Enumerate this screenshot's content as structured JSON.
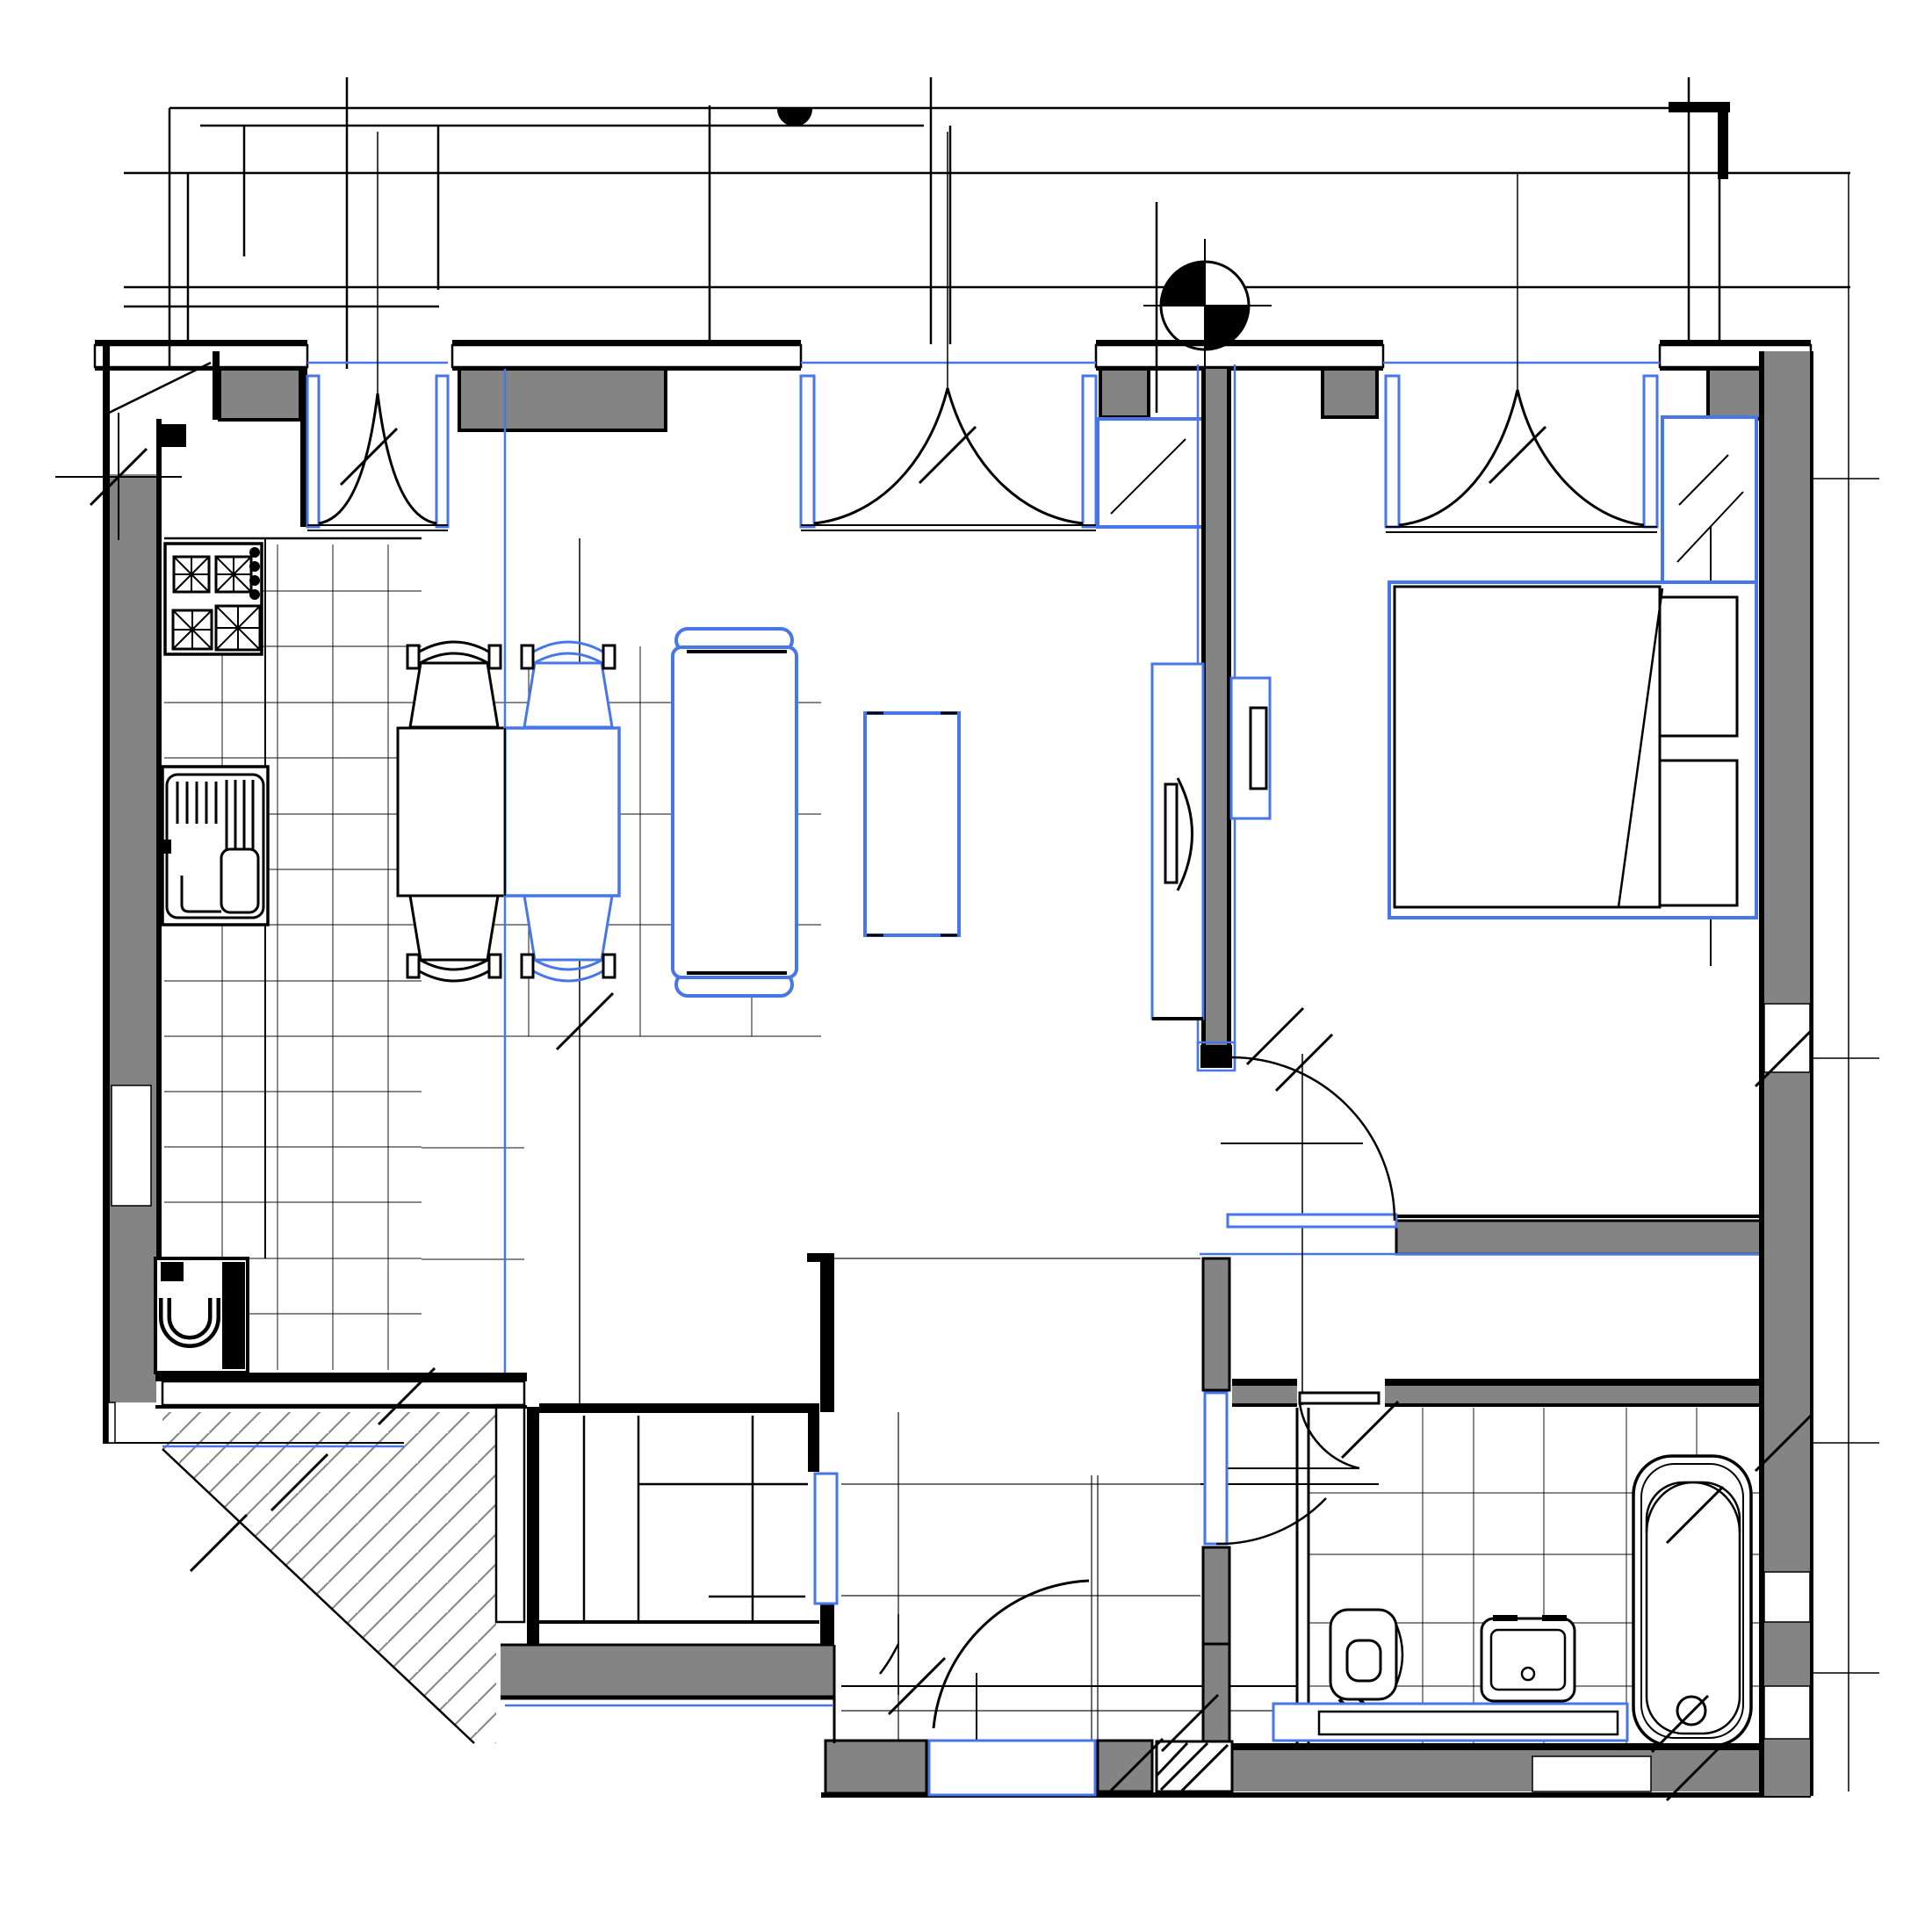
{
  "meta": {
    "document_kind": "architectural-floor-plan",
    "description": "One-bedroom apartment CAD floor plan with existing (black) and proposed (blue) layout layers",
    "visible_text": []
  },
  "colors": {
    "line": "#000000",
    "wall": "#848484",
    "blue": "#4676e8",
    "hatch": "#8a8a8a",
    "bg": "#ffffff"
  },
  "layers": [
    {
      "id": "existing",
      "label": "existing construction (black)"
    },
    {
      "id": "proposed",
      "label": "proposed / furniture layer (blue)"
    }
  ],
  "rooms": [
    {
      "id": "kitchen-living",
      "label": "Kitchen / living room"
    },
    {
      "id": "bedroom",
      "label": "Bedroom"
    },
    {
      "id": "bathroom",
      "label": "Bathroom"
    },
    {
      "id": "hallway",
      "label": "Entry hallway"
    },
    {
      "id": "wardrobe",
      "label": "Wardrobe room"
    },
    {
      "id": "facade",
      "label": "Facade / balcony zone above plan"
    }
  ],
  "fixtures": [
    {
      "id": "stove",
      "label": "4-burner cooktop with control knobs"
    },
    {
      "id": "kitchen-sink",
      "label": "Kitchen sink with drainer"
    },
    {
      "id": "water-heater",
      "label": "Water heater / washing unit"
    },
    {
      "id": "dining-table",
      "label": "Dining table (black + blue halves)"
    },
    {
      "id": "chairs",
      "label": "Four dining chairs (2 black, 2 blue)"
    },
    {
      "id": "sofa",
      "label": "Sofa (blue layer)"
    },
    {
      "id": "coffee-table",
      "label": "Coffee table (blue layer)"
    },
    {
      "id": "tv-unit",
      "label": "TV wall unit on partition"
    },
    {
      "id": "bed",
      "label": "Double bed with pillows"
    },
    {
      "id": "bedroom-shelf",
      "label": "Bedroom-side shelf on partition"
    },
    {
      "id": "wardrobe-unit",
      "label": "Built-in wardrobe with rail"
    },
    {
      "id": "toilet",
      "label": "Wall-hung toilet"
    },
    {
      "id": "washbasin",
      "label": "Washbasin"
    },
    {
      "id": "vanity-counter",
      "label": "Bathroom counter (blue layer)"
    },
    {
      "id": "bathtub",
      "label": "Bathtub with drain"
    },
    {
      "id": "entry-threshold",
      "label": "Entry threshold (blue layer)"
    }
  ],
  "doors": [
    {
      "id": "balcony-door-kitchen",
      "label": "Balcony French door - kitchen"
    },
    {
      "id": "balcony-door-living",
      "label": "Balcony French door - living room"
    },
    {
      "id": "balcony-door-bedroom",
      "label": "Balcony French door - bedroom"
    },
    {
      "id": "bedroom-door",
      "label": "Bedroom swing door (blue leaf)"
    },
    {
      "id": "bathroom-door",
      "label": "Bathroom swing door (black leaf)"
    },
    {
      "id": "vestibule-door",
      "label": "Bathroom vestibule door (blue leaf)"
    },
    {
      "id": "wardrobe-door",
      "label": "Wardrobe door (blue leaf)"
    },
    {
      "id": "entry-door",
      "label": "Apartment entry door with swing arc"
    }
  ],
  "symbols": [
    {
      "id": "survey-marker",
      "label": "Quartered survey/benchmark circle"
    },
    {
      "id": "north-half-disc",
      "label": "Filled half-disc marker on facade line"
    },
    {
      "id": "dimension-ticks",
      "label": "45-degree dimension tick marks"
    },
    {
      "id": "cross-hatch",
      "label": "Cross-hatched masonry wall bands"
    },
    {
      "id": "diagonal-hatch",
      "label": "Diagonal-hatched shaft / common area"
    }
  ]
}
